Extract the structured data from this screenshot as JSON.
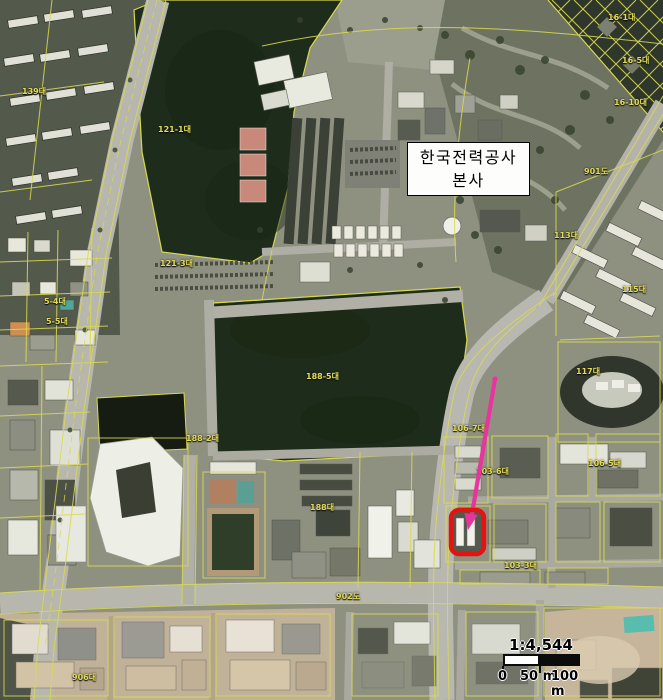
{
  "map": {
    "title_label": {
      "line1": "한국전력공사",
      "line2": "본사"
    },
    "scale": {
      "ratio_label": "1:4,544",
      "ticks": [
        "0",
        "50 m",
        "100 m"
      ]
    },
    "colors": {
      "cadastral_line": "#d9d94e",
      "parcel_label_text": "#e3dc55",
      "highlight_outline": "#e51212",
      "pointer_arrow": "#e8359e",
      "scale_bar_dark": "#0b0b0b",
      "scale_bar_light": "#ffffff",
      "label_box_bg": "#fdfdfb",
      "label_box_border": "#000000",
      "dark_parcel_fill": "#1e2c1c"
    },
    "parcel_labels": [
      {
        "text": "139대",
        "x": 22,
        "y": 86
      },
      {
        "text": "121-1대",
        "x": 158,
        "y": 124
      },
      {
        "text": "121-3대",
        "x": 160,
        "y": 258
      },
      {
        "text": "5-4대",
        "x": 44,
        "y": 296
      },
      {
        "text": "5-5대",
        "x": 46,
        "y": 316
      },
      {
        "text": "188-5대",
        "x": 306,
        "y": 371
      },
      {
        "text": "188-2대",
        "x": 186,
        "y": 433
      },
      {
        "text": "188대",
        "x": 310,
        "y": 502
      },
      {
        "text": "106-7대",
        "x": 452,
        "y": 423
      },
      {
        "text": "103-6대",
        "x": 476,
        "y": 466
      },
      {
        "text": "106-5대",
        "x": 588,
        "y": 458
      },
      {
        "text": "103-3대",
        "x": 504,
        "y": 560
      },
      {
        "text": "113대",
        "x": 554,
        "y": 230
      },
      {
        "text": "115대",
        "x": 622,
        "y": 284
      },
      {
        "text": "117대",
        "x": 576,
        "y": 366
      },
      {
        "text": "901도",
        "x": 584,
        "y": 166
      },
      {
        "text": "902도",
        "x": 336,
        "y": 591
      },
      {
        "text": "906대",
        "x": 72,
        "y": 672
      },
      {
        "text": "16-1대",
        "x": 608,
        "y": 12
      },
      {
        "text": "16-5대",
        "x": 622,
        "y": 55
      },
      {
        "text": "16-10대",
        "x": 614,
        "y": 97
      }
    ]
  }
}
